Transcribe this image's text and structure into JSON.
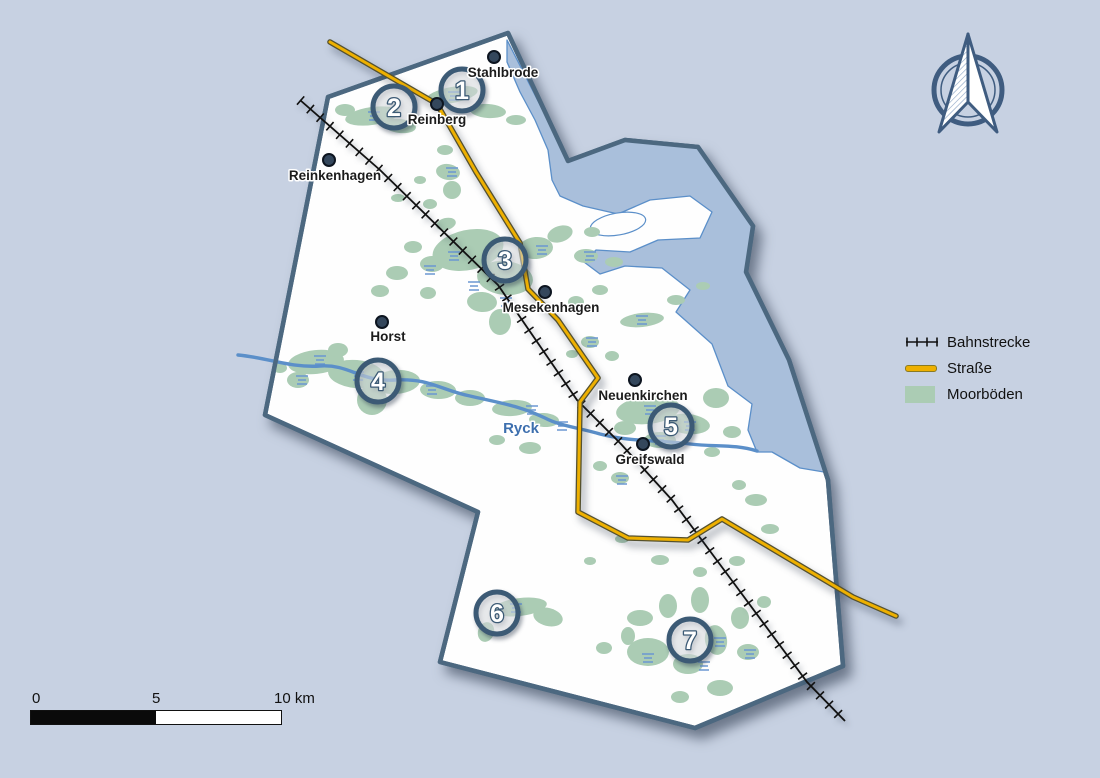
{
  "places": {
    "stahlbrode": "Stahlbrode",
    "reinberg": "Reinberg",
    "reinkenhagen": "Reinkenhagen",
    "horst": "Horst",
    "mesekenhagen": "Mesekenhagen",
    "neuenkirchen": "Neuenkirchen",
    "greifswald": "Greifswald"
  },
  "river_label": "Ryck",
  "site_markers": [
    "1",
    "2",
    "3",
    "4",
    "5",
    "6",
    "7"
  ],
  "legend": {
    "items": [
      {
        "id": "railway",
        "label": "Bahnstrecke"
      },
      {
        "id": "road",
        "label": "Straße"
      },
      {
        "id": "moor",
        "label": "Moorböden"
      }
    ]
  },
  "scale_bar": {
    "tick_labels": [
      "0",
      "5",
      "10 km"
    ]
  },
  "colors": {
    "background": "#c7d1e2",
    "land": "#ffffff",
    "water": "#a9bfdb",
    "water_outline": "#5b8fc9",
    "moor": "#abccb4",
    "wetland_mark": "#6b97d2",
    "boundary": "#4c6880",
    "railway": "#111111",
    "road": "#eeb000",
    "road_casing": "#55512f",
    "river": "#5b8fc9",
    "marker_ring": "#3c5a75",
    "town_dot": "#34475c"
  }
}
